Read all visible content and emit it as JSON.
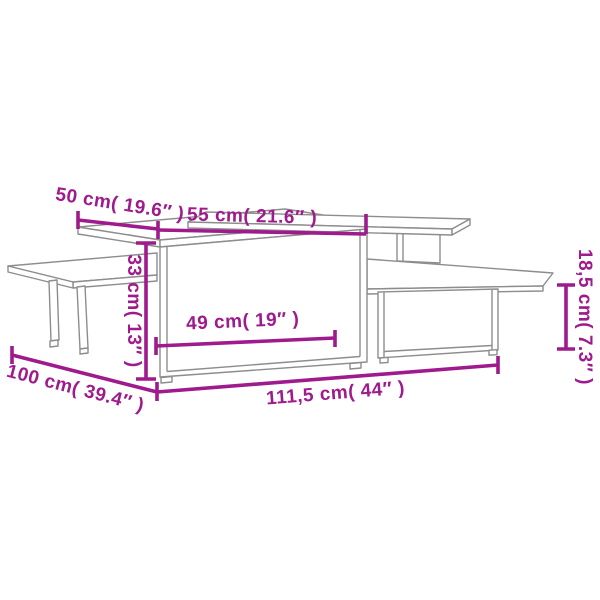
{
  "colors": {
    "dimension": "#9e1a8d",
    "furniture": "#8d8d8d",
    "bg": "#ffffff"
  },
  "diagram": {
    "kind": "product dimension drawing",
    "subject": "nesting coffee tables"
  },
  "labels": {
    "top_depth": "50 cm( 19.6″ )",
    "top_width": "55 cm( 21.6″ )",
    "table_height": "33 cm( 13″ )",
    "inner_width": "49 cm( 19″ )",
    "overall_width": "111,5 cm( 44″ )",
    "overall_depth": "100 cm( 39.4″ )",
    "shelf_height": "18,5 cm( 7.3″ )"
  }
}
